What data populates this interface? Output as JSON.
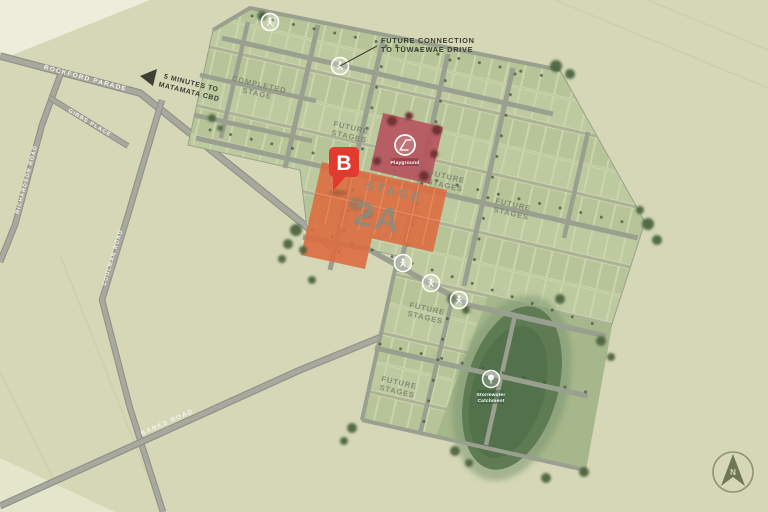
{
  "map": {
    "notes": {
      "future_connection_line1": "FUTURE CONNECTION",
      "future_connection_line2": "TO TŪWAEWAE DRIVE",
      "cbd_line1": "5 MINUTES TO",
      "cbd_line2": "MATAMATA CBD"
    },
    "roads": {
      "rockford": "ROCKFORD PARADE",
      "gibbs": "GIBBS PLACE",
      "richardson": "RICHARDSON ROAD",
      "coulman": "COULMAN ROAD",
      "banks": "BANKS ROAD"
    },
    "areas": {
      "completed_line1": "COMPLETED",
      "completed_line2": "STAGE",
      "future_line1": "FUTURE",
      "future_line2": "STAGES",
      "stage2a_line1": "STAGE",
      "stage2a_line2": "2A",
      "playground": "Playground",
      "stormwater_line1": "Stormwater",
      "stormwater_line2": "Catchment"
    },
    "markers": {
      "pin_b": "B",
      "compass": "N"
    },
    "colors": {
      "map_background": "#d5d7b6",
      "lot_green": "#b9c69b",
      "road_gray": "#a3a49a",
      "stage2a_orange": "#dd6a3f",
      "playground_red": "#b65560",
      "pin_red": "#e23a2e",
      "pond_green": "#5e7b54",
      "tree_green": "#49623e",
      "label_gray": "#787e72"
    }
  }
}
